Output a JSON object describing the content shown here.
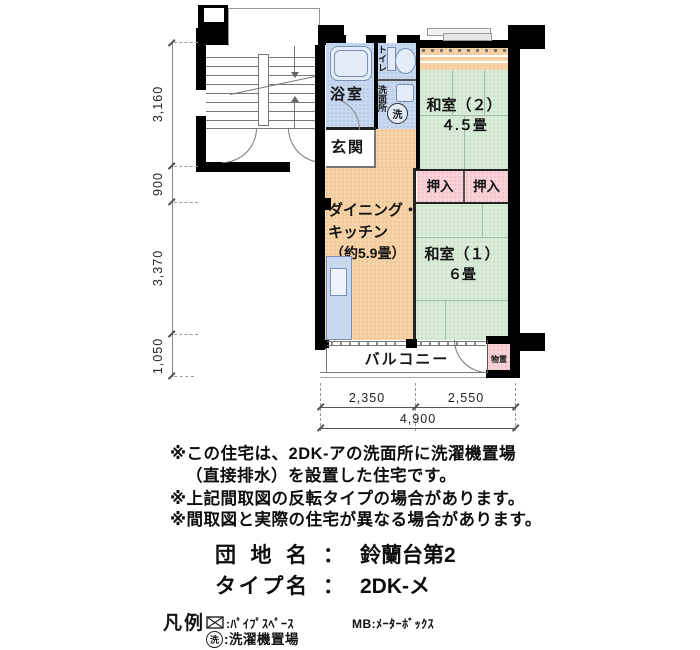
{
  "plan": {
    "rooms": {
      "bath": {
        "label": "浴室"
      },
      "toilet": {
        "label": "トイレ"
      },
      "washroom": {
        "label": "洗面所"
      },
      "washer_mark": "洗",
      "entrance": {
        "label": "玄関"
      },
      "dining_kitchen": {
        "line1": "ダイニング・",
        "line2": "キッチン",
        "line3": "（約5.9畳）"
      },
      "washitsu2": {
        "label": "和室（２）",
        "size": "４.５畳"
      },
      "washitsu1": {
        "label": "和室（１）",
        "size": "６畳"
      },
      "closet_left": {
        "label": "押入"
      },
      "closet_right": {
        "label": "押入"
      },
      "balcony": {
        "label": "バルコニー"
      },
      "storage": {
        "label": "物置"
      }
    },
    "dimensions": {
      "left": [
        "3,160",
        "900",
        "3,370",
        "1,050"
      ],
      "bottom": [
        "2,350",
        "2,550"
      ],
      "bottom_total": "4,900"
    },
    "palette": {
      "tatami_green": "#d9ecd9",
      "dk_orange": "#f6d3a6",
      "closet_pink": "#f8d2d7",
      "wet_area_blue": "#c8d8ef",
      "wall_black": "#000000"
    }
  },
  "notes": {
    "line1": "※この住宅は、2DK-アの洗面所に洗濯機置場",
    "line2": "（直接排水）を設置した住宅です。",
    "line3": "※上記間取図の反転タイプの場合があります。",
    "line4": "※間取図と実際の住宅が異なる場合があります。"
  },
  "info": {
    "estate_label": "団地名",
    "estate_sep": "：",
    "estate_value": "鈴蘭台第2",
    "type_label": "タイプ名",
    "type_sep": "：",
    "type_value": "2DK-メ"
  },
  "legend": {
    "title": "凡例",
    "pipe_space_label": ":ﾊﾟｲﾌﾟｽﾍﾟｰｽ",
    "mb_label": "MB:ﾒｰﾀｰﾎﾞｯｸｽ",
    "washer_mark": "洗",
    "washer_label": ":洗濯機置場"
  }
}
